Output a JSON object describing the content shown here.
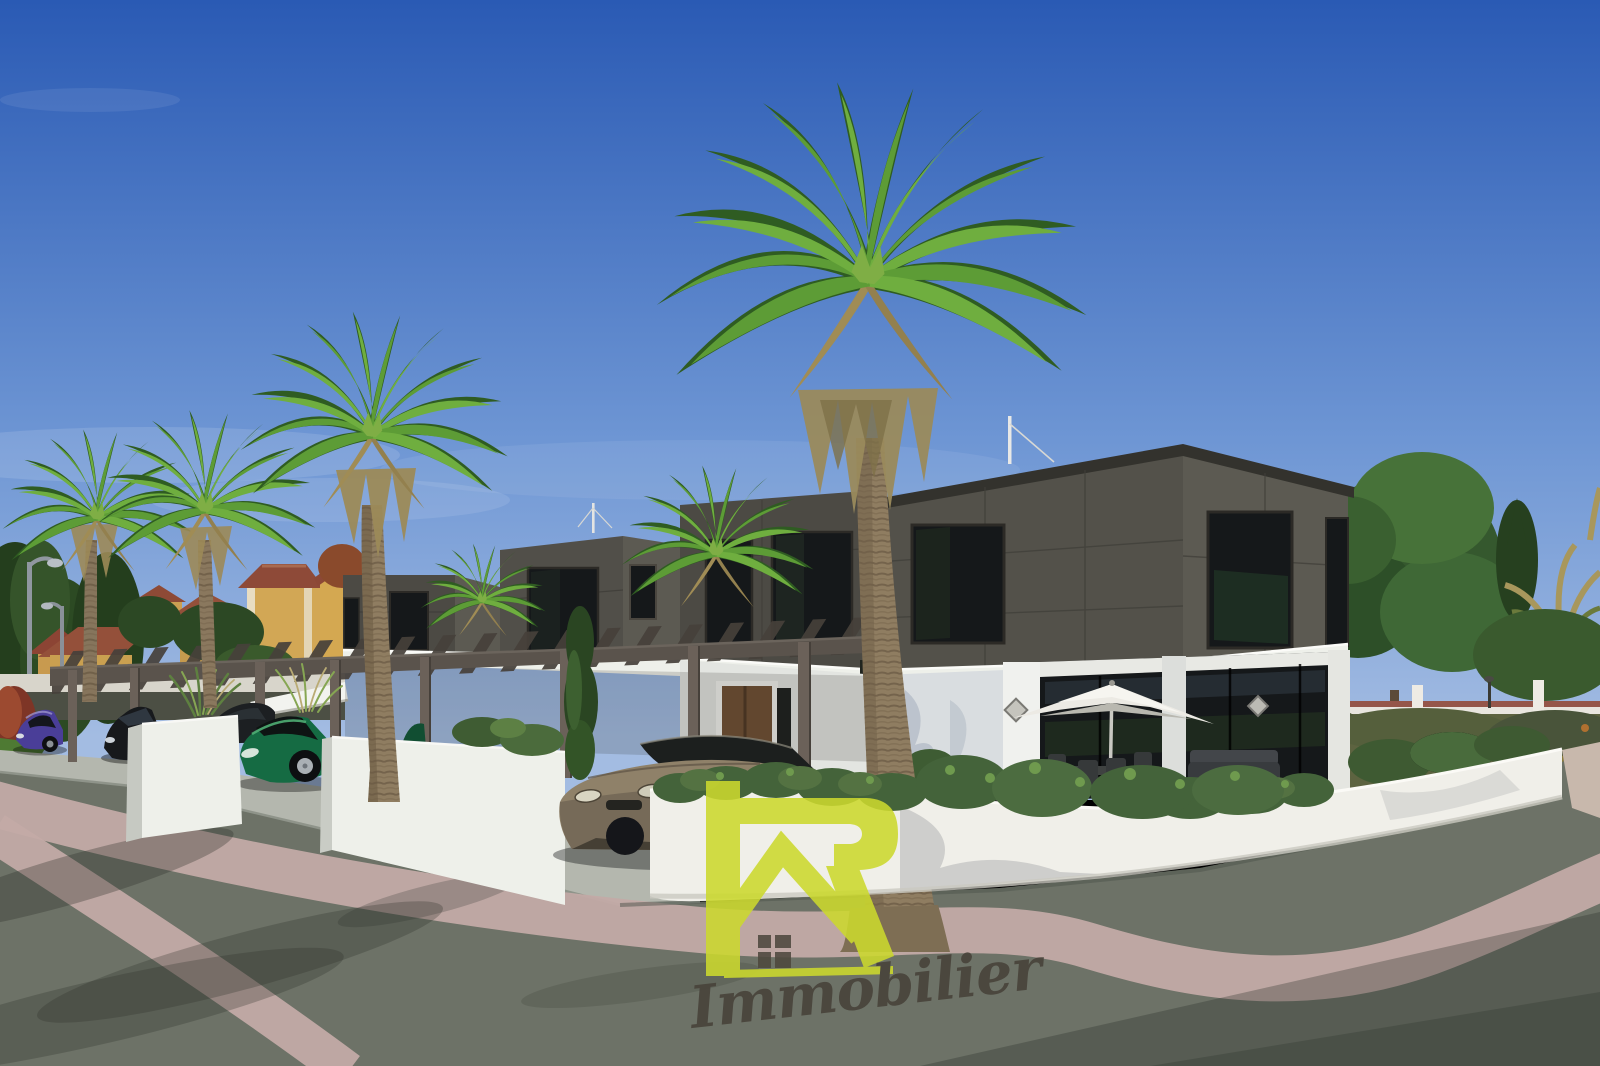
{
  "watermark": {
    "brand_letter": "R",
    "brand_name": "Immobilier"
  },
  "colors": {
    "sky_top": "#2a5ab4",
    "sky_mid": "#6e96d4",
    "sky_horizon": "#a3bce2",
    "facade_dark": "#53514a",
    "facade_dark_front": "#4c4a44",
    "facade_dark_side": "#5c5a52",
    "roof_cap": "#33322d",
    "facade_white": "#eef0ea",
    "wall_white": "#f0efe9",
    "glass_dark": "#15181a",
    "road": "#6d7267",
    "sidewalk": "#b4b7ae",
    "stripe_pink": "#c3aaa6",
    "palm_green": "#5d9c36",
    "palm_green2": "#6fae3f",
    "palm_dark": "#2f5c22",
    "palm_trunk": "#8f7d61",
    "pergola_wood": "#5a534c",
    "pergola_post": "#6b6159",
    "house_yellow": "#cfa053",
    "roof_tile": "#94503a",
    "hedge_green": "#44633a",
    "car_purple": "#4a3e98",
    "car_black": "#17191c",
    "car_green": "#156b43",
    "car_bronze": "#8f8169",
    "logo_green": "#ccd92e",
    "logo_text": "#474239",
    "umbrella_white": "#eceae4"
  },
  "scene": {
    "description": "3D architectural rendering of a modern townhouse development: dark-clad upper storeys over white ground floors, wooden pergola carports, palm trees, parked cars and a street curving around a white corner wall, with Mediterranean villas behind.",
    "objects": [
      "sky",
      "palm-trees",
      "modern-townhouses",
      "mediterranean-houses",
      "pergola-carport",
      "parked-cars",
      "street",
      "garden-walls",
      "hedges",
      "patio-umbrella",
      "street-lamps",
      "sail-mast",
      "watermark-logo"
    ],
    "cars": [
      {
        "color_name": "purple"
      },
      {
        "color_name": "black"
      },
      {
        "color_name": "dark-gray"
      },
      {
        "color_name": "green"
      },
      {
        "color_name": "bronze"
      }
    ]
  }
}
